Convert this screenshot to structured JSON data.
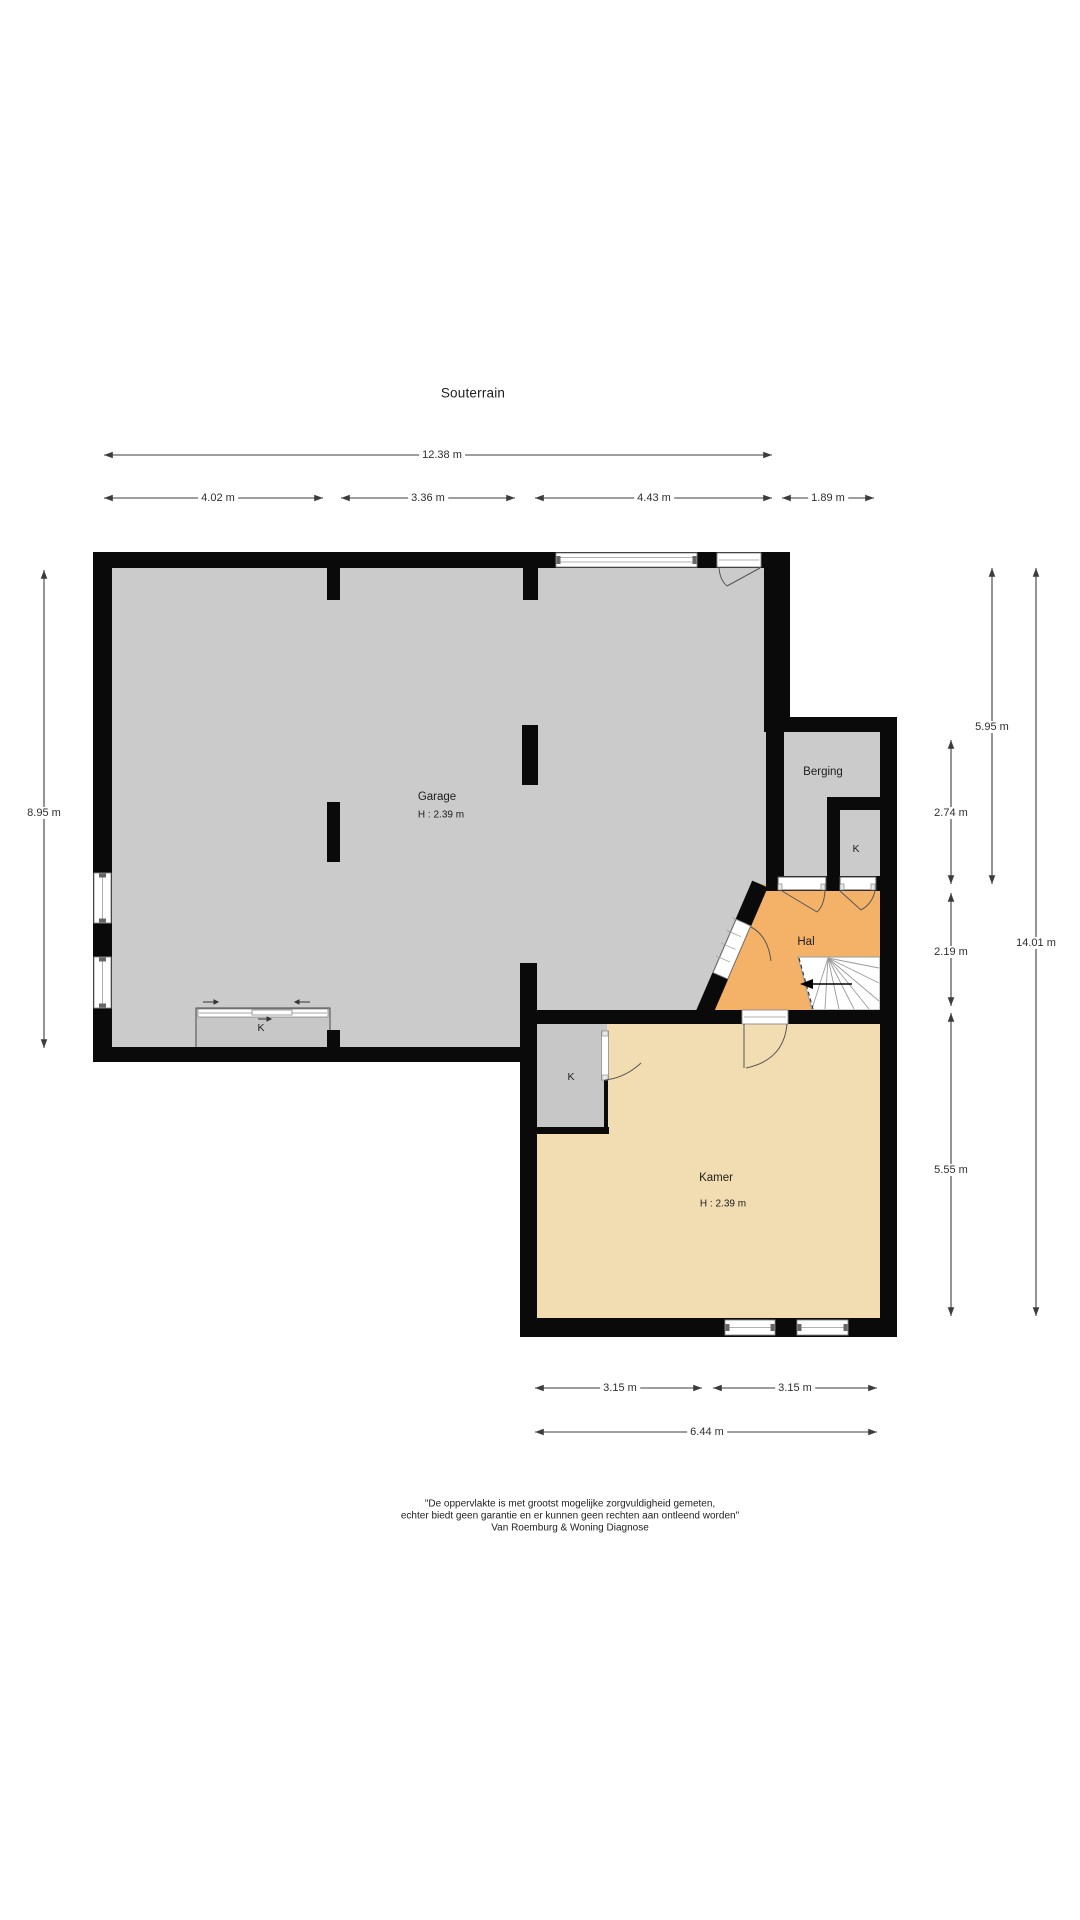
{
  "title": "Souterrain",
  "rooms": {
    "garage": {
      "label": "Garage",
      "height": "H : 2.39 m"
    },
    "berging": {
      "label": "Berging"
    },
    "berging_closet": {
      "label": "K"
    },
    "hal": {
      "label": "Hal"
    },
    "garage_closet": {
      "label": "K"
    },
    "kamer_closet": {
      "label": "K"
    },
    "kamer": {
      "label": "Kamer",
      "height": "H : 2.39 m"
    }
  },
  "dimensions": {
    "top_total": {
      "label": "12.38 m"
    },
    "top_segments": [
      {
        "label": "4.02 m"
      },
      {
        "label": "3.36 m"
      },
      {
        "label": "4.43 m"
      },
      {
        "label": "1.89 m"
      }
    ],
    "left": {
      "label": "8.95 m"
    },
    "right": [
      {
        "label": "5.95 m"
      },
      {
        "label": "2.74 m"
      },
      {
        "label": "2.19 m"
      },
      {
        "label": "5.55 m"
      },
      {
        "label": "14.01 m"
      }
    ],
    "bottom_segments": [
      {
        "label": "3.15 m"
      },
      {
        "label": "3.15 m"
      }
    ],
    "bottom_total": {
      "label": "6.44 m"
    }
  },
  "disclaimer": {
    "line1": "\"De oppervlakte is met grootst mogelijke zorgvuldigheid gemeten,",
    "line2": "echter biedt geen garantie en er kunnen geen rechten aan ontleend worden\"",
    "line3": "Van Roemburg & Woning Diagnose"
  },
  "colors": {
    "wall": "#0a0a0a",
    "garage_floor": "#cbcbcb",
    "berging_floor": "#cbcbcb",
    "closet_floor": "#c7c7c7",
    "hal_floor": "#f4b269",
    "kamer_floor": "#f2dcb2",
    "dimension_line": "#3c3c3c",
    "stair_line": "#9a9a9a"
  }
}
